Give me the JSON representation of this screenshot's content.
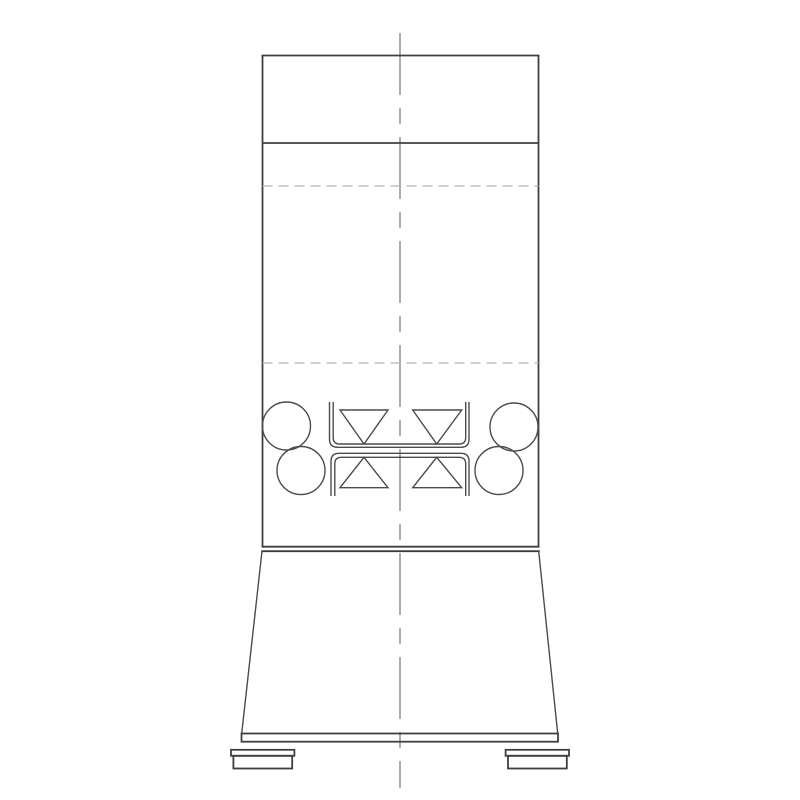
{
  "drawing": {
    "canvas": {
      "width": 800,
      "height": 800,
      "background": "#ffffff"
    },
    "styles": {
      "heavy": {
        "stroke": "#3f3f3f",
        "width": 1.8
      },
      "medium": {
        "stroke": "#4c4c4c",
        "width": 1.4
      },
      "dashed": {
        "stroke": "#b3b3b3",
        "width": 1.3,
        "dash": "10 6"
      },
      "center": {
        "stroke": "#a3a3a3",
        "width": 1.8,
        "dash": "62 13 16 13"
      }
    },
    "elements": [
      {
        "name": "vertical-centerline",
        "type": "line",
        "style": "center",
        "x1": 400,
        "y1": 33,
        "x2": 400,
        "y2": 788
      },
      {
        "name": "body-top-edge",
        "type": "line",
        "style": "heavy",
        "x1": 261.6,
        "y1": 55.5,
        "x2": 539.4,
        "y2": 55.5
      },
      {
        "name": "body-left-wall",
        "type": "line",
        "style": "heavy",
        "x1": 262.5,
        "y1": 55.5,
        "x2": 262.5,
        "y2": 547
      },
      {
        "name": "body-right-wall",
        "type": "line",
        "style": "heavy",
        "x1": 538.5,
        "y1": 55.5,
        "x2": 538.5,
        "y2": 547
      },
      {
        "name": "head-divider-line",
        "type": "line",
        "style": "heavy",
        "x1": 262.5,
        "y1": 143,
        "x2": 538.5,
        "y2": 143
      },
      {
        "name": "upper-hidden-line",
        "type": "line",
        "style": "dashed",
        "x1": 262.5,
        "y1": 186,
        "x2": 538.5,
        "y2": 186
      },
      {
        "name": "lower-hidden-line",
        "type": "line",
        "style": "dashed",
        "x1": 262.5,
        "y1": 363,
        "x2": 538.5,
        "y2": 363
      },
      {
        "name": "roller-circle-left-upper",
        "type": "circle",
        "style": "medium",
        "cx": 286.5,
        "cy": 426,
        "r": 24
      },
      {
        "name": "roller-circle-left-lower",
        "type": "circle",
        "style": "medium",
        "cx": 301,
        "cy": 470.5,
        "r": 24
      },
      {
        "name": "roller-circle-right-upper",
        "type": "circle",
        "style": "medium",
        "cx": 514,
        "cy": 427,
        "r": 24
      },
      {
        "name": "roller-circle-right-lower",
        "type": "circle",
        "style": "medium",
        "cx": 499,
        "cy": 470.5,
        "r": 24
      },
      {
        "name": "upper-channel-outer",
        "type": "path",
        "style": "medium",
        "d": "M 329.5 402 L 329.5 439.3 Q 329.5 447.3 337.5 447.3 L 461 447.3 Q 469 447.3 469 439.3 L 469 402"
      },
      {
        "name": "upper-channel-inner",
        "type": "path",
        "style": "medium",
        "d": "M 333.2 402 L 333.2 437.5 Q 333.2 444 339.7 444 L 459.2 444 Q 465.7 444 465.7 437.5 L 465.7 402"
      },
      {
        "name": "lower-channel-outer",
        "type": "path",
        "style": "medium",
        "d": "M 331 496 L 331 461.3 Q 331 453.3 339 453.3 L 461 453.3 Q 469 453.3 469 461.3 L 469 496"
      },
      {
        "name": "lower-channel-inner",
        "type": "path",
        "style": "medium",
        "d": "M 334.8 496 L 334.8 463.8 Q 334.8 457.3 341.3 457.3 L 459.2 457.3 Q 465.7 457.3 465.7 463.8 L 465.7 496"
      },
      {
        "name": "wedge-upper-left",
        "type": "polygon",
        "style": "medium",
        "points": "340,410 388,410 364,444"
      },
      {
        "name": "wedge-upper-right",
        "type": "polygon",
        "style": "medium",
        "points": "412.7,410 461.7,410 436.7,444"
      },
      {
        "name": "wedge-lower-left",
        "type": "polygon",
        "style": "medium",
        "points": "364,457.3 388,487.7 340,487.7"
      },
      {
        "name": "wedge-lower-right",
        "type": "polygon",
        "style": "medium",
        "points": "436.7,457.3 461.7,487.7 412.7,487.7"
      },
      {
        "name": "waist-line-upper",
        "type": "line",
        "style": "heavy",
        "x1": 261.6,
        "y1": 546.7,
        "x2": 539.4,
        "y2": 546.7
      },
      {
        "name": "waist-line-lower",
        "type": "line",
        "style": "heavy",
        "x1": 261.2,
        "y1": 551.2,
        "x2": 539.8,
        "y2": 551.2
      },
      {
        "name": "skirt-left-edge",
        "type": "line",
        "style": "medium",
        "x1": 262,
        "y1": 551.2,
        "x2": 241.7,
        "y2": 733.5
      },
      {
        "name": "skirt-right-edge",
        "type": "line",
        "style": "medium",
        "x1": 538.7,
        "y1": 551.2,
        "x2": 557.7,
        "y2": 733.5
      },
      {
        "name": "base-plate",
        "type": "rect",
        "style": "heavy",
        "x": 241.5,
        "y": 733.5,
        "w": 316.5,
        "h": 8.2
      },
      {
        "name": "left-foot-flange",
        "type": "rect",
        "style": "heavy",
        "x": 231,
        "y": 749.8,
        "w": 63.4,
        "h": 6
      },
      {
        "name": "left-foot-body",
        "type": "rect",
        "style": "heavy",
        "x": 233.4,
        "y": 755.8,
        "w": 58.8,
        "h": 12.7
      },
      {
        "name": "right-foot-flange",
        "type": "rect",
        "style": "heavy",
        "x": 505.6,
        "y": 749.8,
        "w": 63.4,
        "h": 6
      },
      {
        "name": "right-foot-body",
        "type": "rect",
        "style": "heavy",
        "x": 508,
        "y": 755.8,
        "w": 58.8,
        "h": 12.7
      }
    ]
  }
}
